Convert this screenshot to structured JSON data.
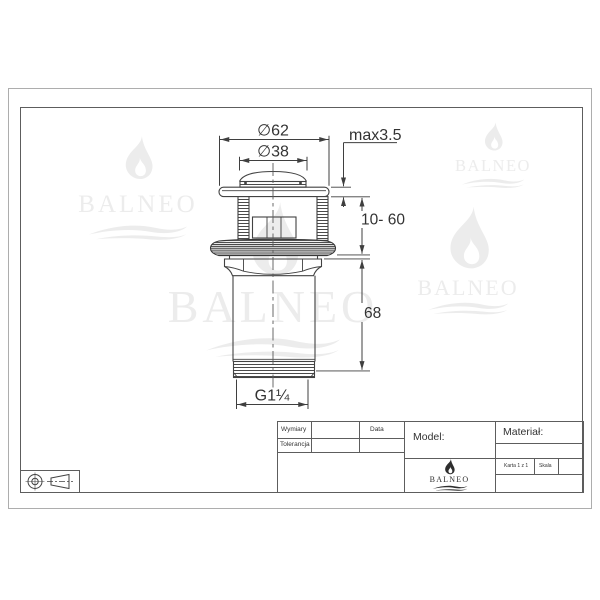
{
  "watermark_text": "BALNEO",
  "drawing": {
    "dim_dia62": "∅62",
    "dim_dia38": "∅38",
    "dim_max": "max3.5",
    "dim_range": "10- 60",
    "dim_height": "68",
    "dim_thread": "G1¼"
  },
  "title_block": {
    "wymiary": "Wymiary",
    "tolerancja": "Tolerancja",
    "data": "Data",
    "model": "Model:",
    "material": "Materiał:",
    "brand": "BALNEO",
    "karta": "Karta 1 z 1",
    "skala": "Skala"
  }
}
